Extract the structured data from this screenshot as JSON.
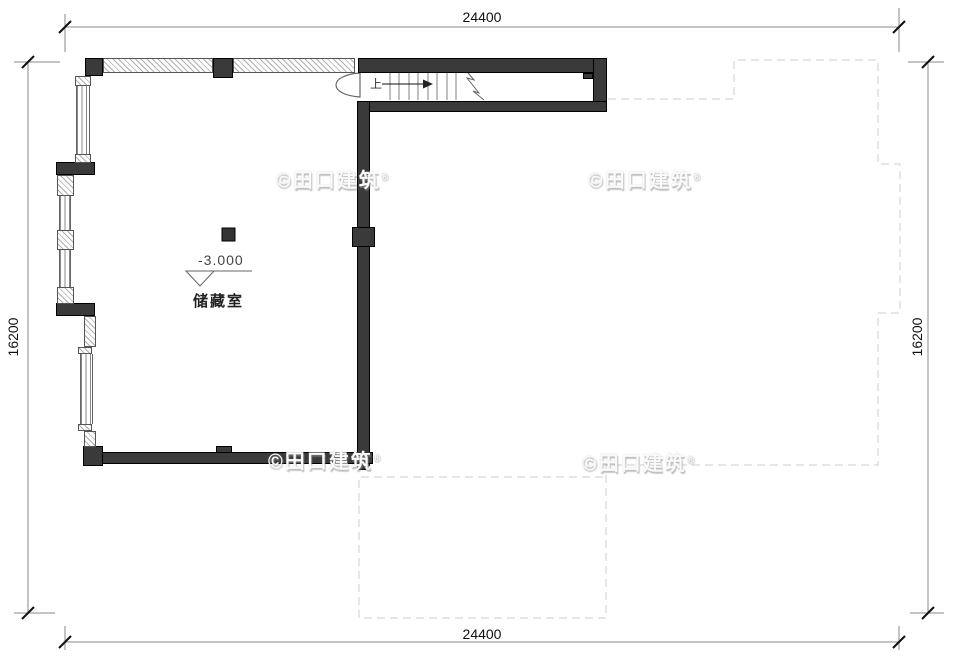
{
  "dimensions": {
    "top": "24400",
    "bottom": "24400",
    "left": "16200",
    "right": "16200"
  },
  "room": {
    "name": "储藏室",
    "elevation": "-3.000"
  },
  "stairs": {
    "up_label": "上"
  },
  "watermark": {
    "text": "©田口建筑",
    "mark": "®"
  },
  "colors": {
    "wall_fill": "#3a3a3a",
    "wall_edge": "#000000",
    "dimension_line": "#8a8a8a",
    "dimension_tick": "#111111",
    "dimension_text": "#111111",
    "dashed_outline": "#cccccc",
    "stair_line": "#808080",
    "annotation_line": "#666666",
    "hatch_line": "#b0b0b0",
    "background": "#ffffff"
  }
}
